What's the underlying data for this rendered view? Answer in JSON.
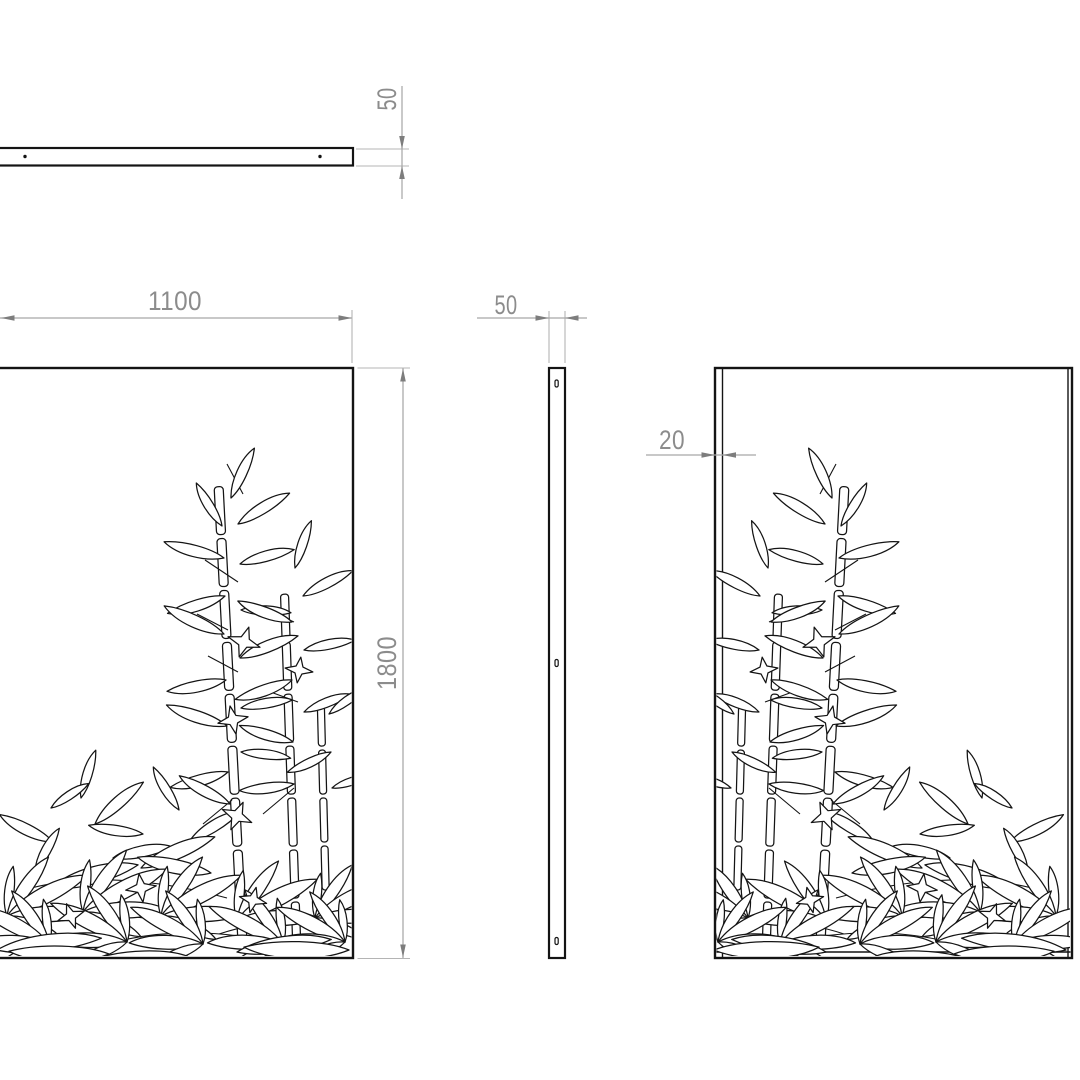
{
  "drawing": {
    "dimensions": {
      "bar_thickness": "50",
      "panel_width": "1100",
      "panel_height": "1800",
      "panel_thickness": "50",
      "flange_offset": "20"
    },
    "colors": {
      "background": "#ffffff",
      "part_line": "#141414",
      "dimension_line": "#a8a8a8",
      "dimension_text": "#8c8c8c"
    }
  }
}
